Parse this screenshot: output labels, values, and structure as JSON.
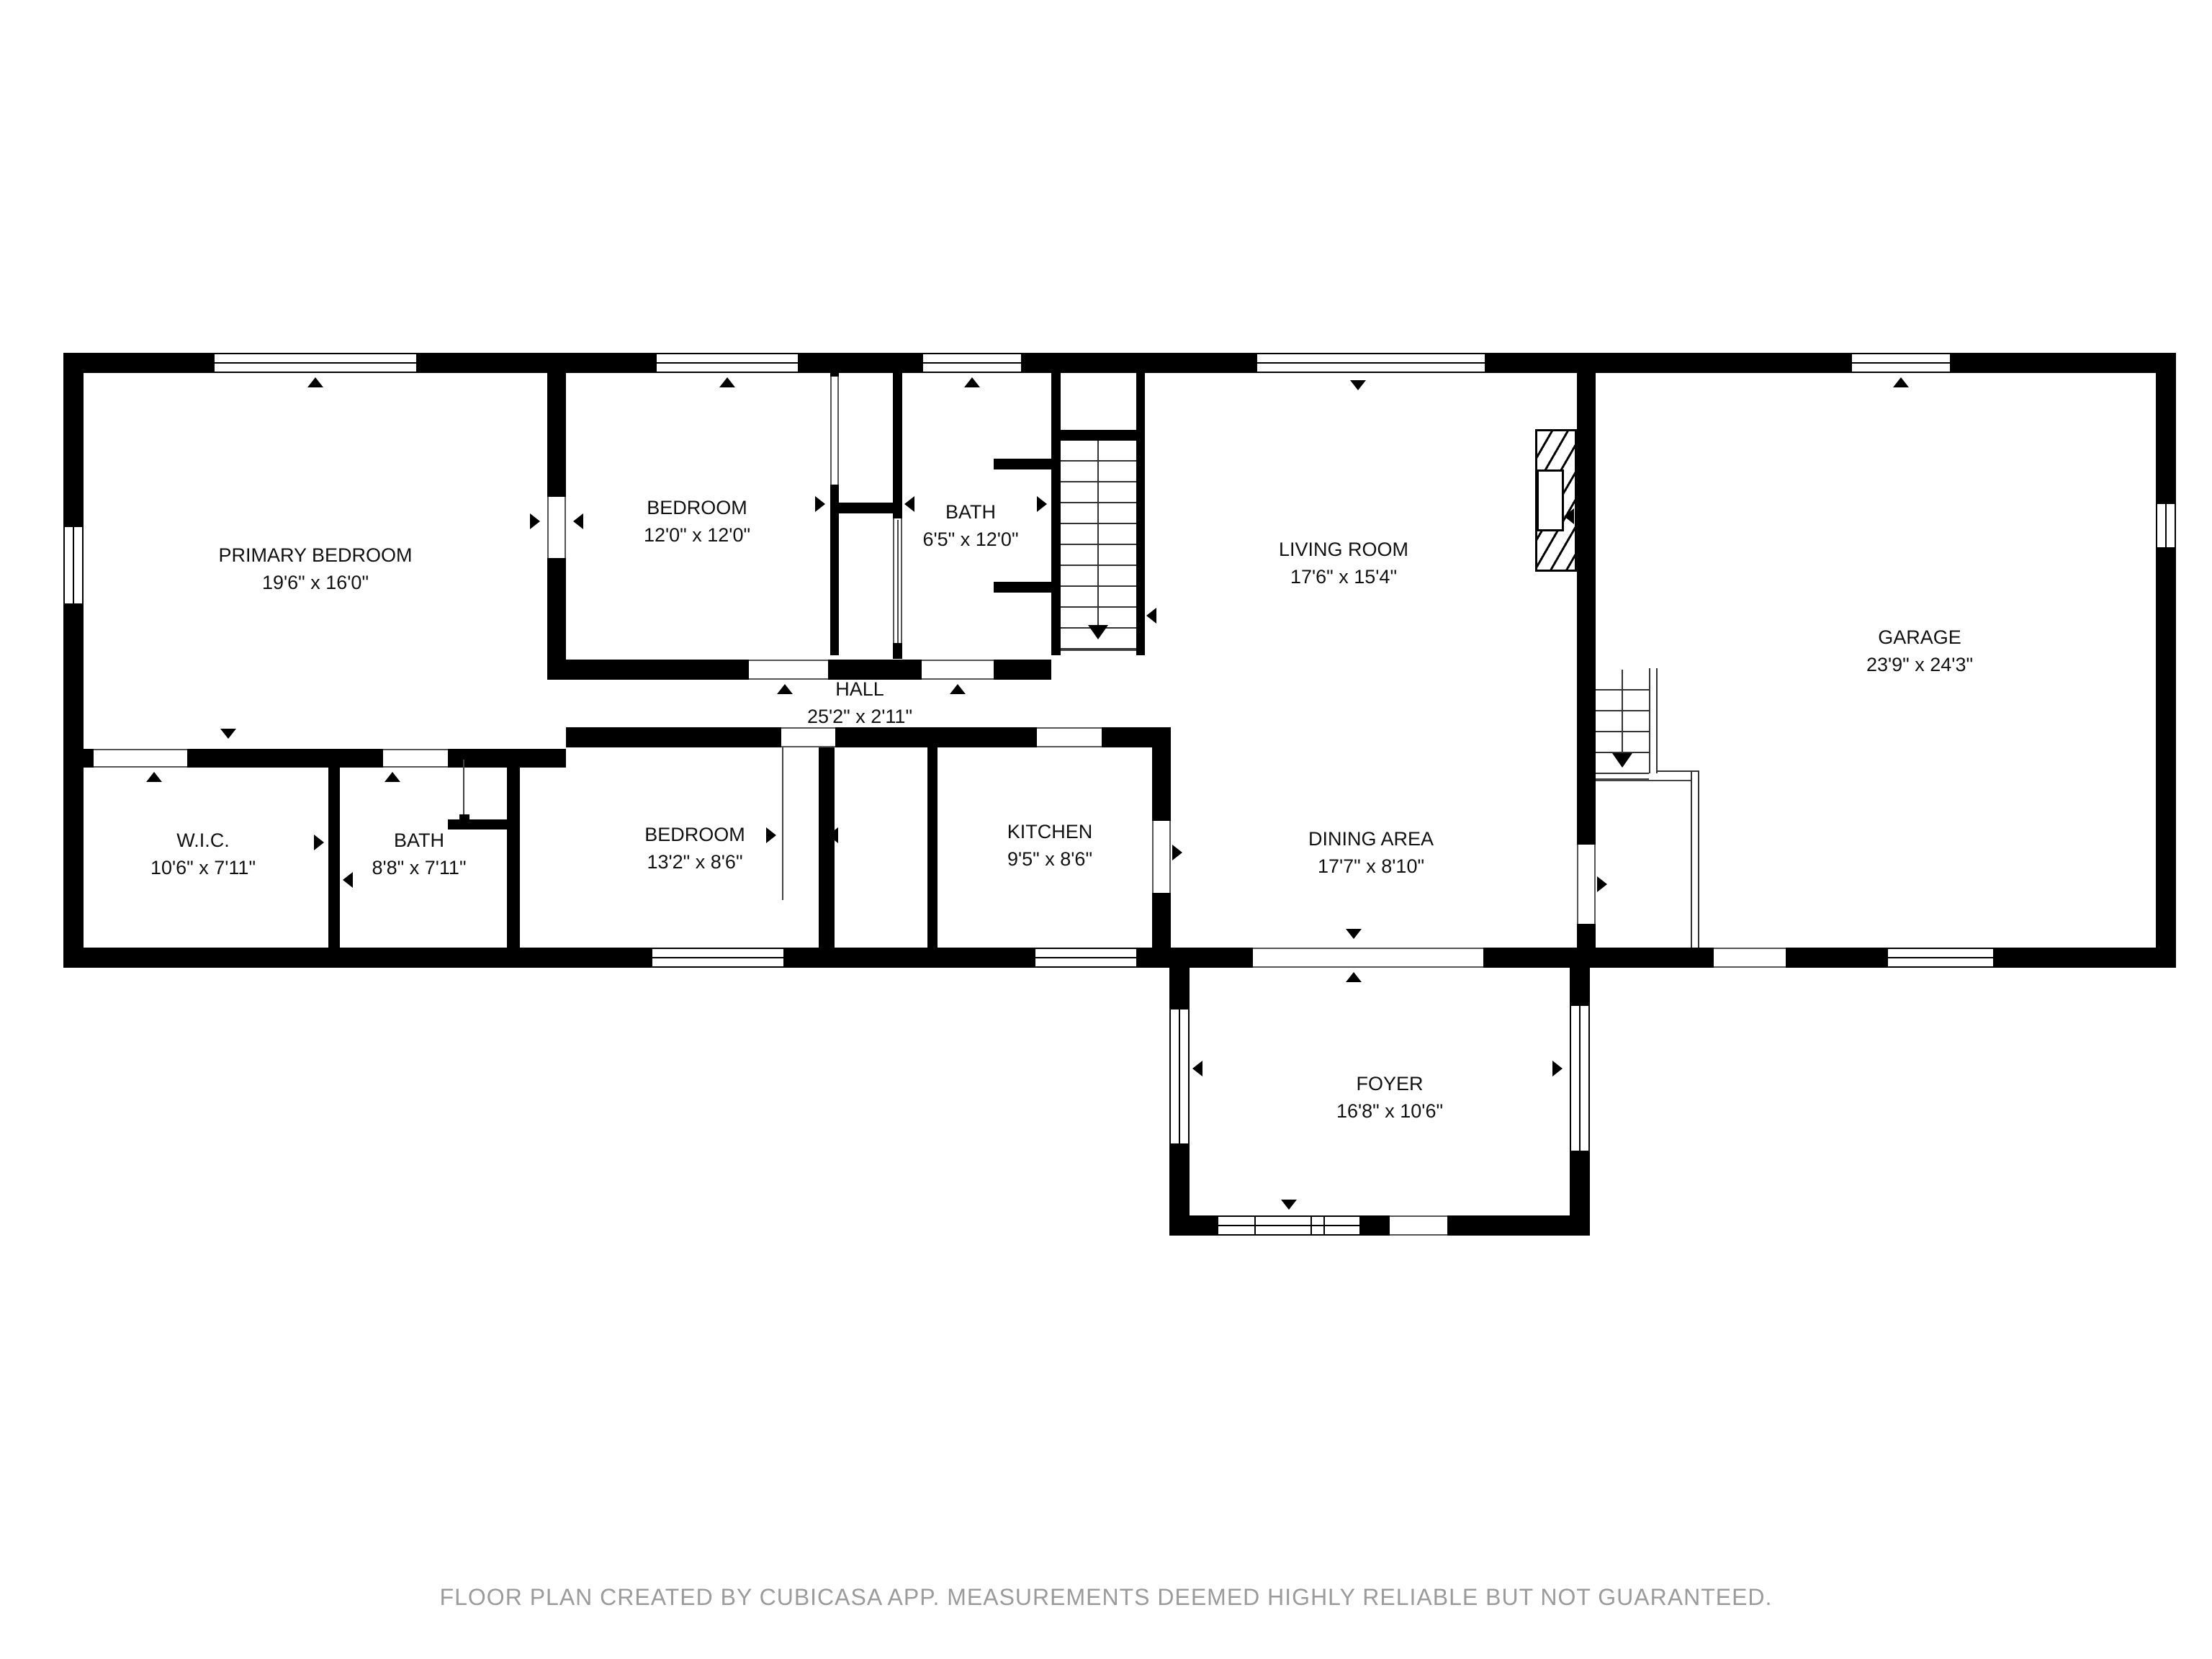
{
  "footer": {
    "text": "FLOOR PLAN CREATED BY CUBICASA APP. MEASUREMENTS DEEMED HIGHLY RELIABLE BUT NOT GUARANTEED."
  },
  "rooms": [
    {
      "id": "primary-bedroom",
      "name": "PRIMARY BEDROOM",
      "dims": "19'6\" x 16'0\""
    },
    {
      "id": "bedroom-top",
      "name": "BEDROOM",
      "dims": "12'0\" x 12'0\""
    },
    {
      "id": "bath-top",
      "name": "BATH",
      "dims": "6'5\" x 12'0\""
    },
    {
      "id": "living-room",
      "name": "LIVING ROOM",
      "dims": "17'6\" x 15'4\""
    },
    {
      "id": "garage",
      "name": "GARAGE",
      "dims": "23'9\" x 24'3\""
    },
    {
      "id": "wic",
      "name": "W.I.C.",
      "dims": "10'6\" x 7'11\""
    },
    {
      "id": "bath-lower",
      "name": "BATH",
      "dims": "8'8\" x 7'11\""
    },
    {
      "id": "bedroom-lower",
      "name": "BEDROOM",
      "dims": "13'2\" x 8'6\""
    },
    {
      "id": "kitchen",
      "name": "KITCHEN",
      "dims": "9'5\" x 8'6\""
    },
    {
      "id": "dining-area",
      "name": "DINING AREA",
      "dims": "17'7\" x 8'10\""
    },
    {
      "id": "hall",
      "name": "HALL",
      "dims": "25'2\" x 2'11\""
    },
    {
      "id": "foyer",
      "name": "FOYER",
      "dims": "16'8\" x 10'6\""
    }
  ],
  "colors": {
    "wall": "#000000",
    "label": "#111111",
    "footer": "#9b9b9b",
    "threshold": "#555555"
  }
}
